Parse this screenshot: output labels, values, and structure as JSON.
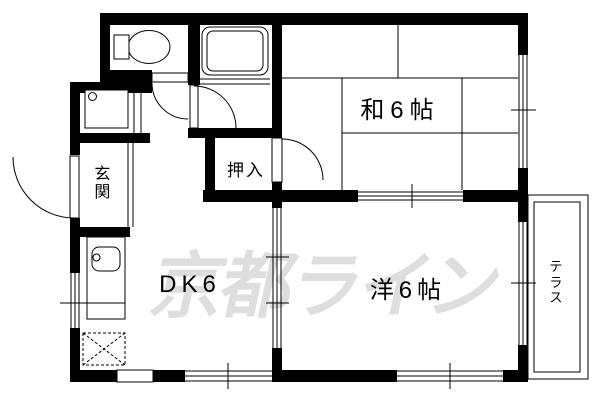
{
  "floorplan": {
    "rooms": {
      "japanese_room": {
        "label": "和6帖"
      },
      "western_room": {
        "label": "洋6帖"
      },
      "dining_kitchen": {
        "label": "DK6"
      },
      "closet": {
        "label": "押入"
      },
      "entrance": {
        "label": "玄関"
      },
      "terrace": {
        "label": "テラス"
      }
    },
    "fixtures": {
      "toilet": "toilet-icon",
      "bathtub": "bathtub-icon",
      "washbasin": "washbasin-icon",
      "kitchen_sink": "kitchen-sink-icon",
      "refrigerator_space": "refrigerator-dashed-box"
    },
    "watermark": {
      "text": "京都ライン",
      "color": "#dedede"
    },
    "colors": {
      "wall": "#000000",
      "line": "#000000",
      "background": "#ffffff"
    }
  }
}
